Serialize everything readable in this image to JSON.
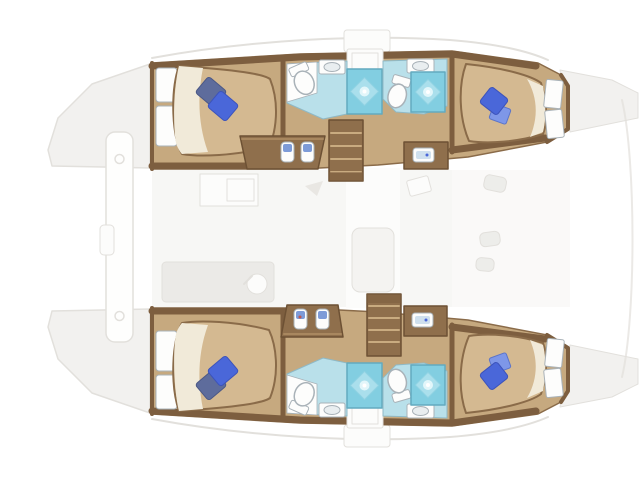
{
  "meta": {
    "description": "Top-down floor plan of a 4-cabin catamaran, bow to the left: two hulls each with a forward double berth cabin, twin bathroom units with toilet, sink and glowing shower pan, an aft double berth cabin, companionway stairs and vanity cabinets; faded salon, cockpit, crossbeam and deck outline between the hulls.",
    "text_on_image": ""
  },
  "palette": {
    "hull_wall": "#7d5e3f",
    "wood": "#8f6f4c",
    "wood_dark": "#6d5134",
    "wood_light": "#a8875f",
    "tread": "#c9ab80",
    "floor": "#c6a97f",
    "bed_top": "#d4b991",
    "bed_sheet": "#f1ead9",
    "bed_outline": "#8a6b49",
    "pillow_dark": "#5e6c9c",
    "pillow_dark_edge": "#4b5886",
    "pillow_blue": "#4a67d9",
    "pillow_blue_edge": "#3c53bb",
    "pillow_light": "#7e97e8",
    "pillow_light_edge": "#5b74c9",
    "bath_floor": "#b9e0ea",
    "bath_edge": "#8fb9c6",
    "shower": "#82cee1",
    "shower_edge": "#62aabf",
    "shower_tile": "#aadfec",
    "shower_tile_edge": "#8ed2e3",
    "shower_glow": "#e2f6fa",
    "fixture_white": "#fdfdfc",
    "fixture_stroke": "#a9b2b8",
    "sink_bowl": "#e9eef0",
    "sink_blue": "#cfe0ee",
    "seat_blue": "#7d9bd8",
    "accent_red": "#c2564f",
    "faded_fill": "#f2f1ef",
    "faded_stroke": "#e2e0dc",
    "salon_panel": "#f3f2f0",
    "walkway": "#fcfcfb"
  },
  "vessel": {
    "type": "catamaran",
    "orientation": "bow-left",
    "hulls": [
      {
        "id": "port-hull",
        "position": "top",
        "rooms": [
          {
            "name": "forward-cabin",
            "berth": "double",
            "pillows": 2,
            "steps": 2
          },
          {
            "name": "bathroom-forward",
            "toilet": 1,
            "sink": 1,
            "shower": 1
          },
          {
            "name": "bathroom-aft",
            "toilet": 1,
            "sink": 1,
            "shower": 1
          },
          {
            "name": "aft-cabin",
            "berth": "double",
            "pillows": 1,
            "windows": 2
          }
        ],
        "companionway": {
          "stairs_treads": 5,
          "desk_seats": 2,
          "vanity_sink": 1
        }
      },
      {
        "id": "starboard-hull",
        "position": "bottom",
        "rooms": [
          {
            "name": "forward-cabin",
            "berth": "double",
            "pillows": 2,
            "steps": 2
          },
          {
            "name": "bathroom-forward",
            "toilet": 1,
            "sink": 1,
            "shower": 1
          },
          {
            "name": "bathroom-aft",
            "toilet": 1,
            "sink": 1,
            "shower": 1
          },
          {
            "name": "aft-cabin",
            "berth": "double",
            "pillows": 1,
            "windows": 2
          }
        ],
        "companionway": {
          "stairs_treads": 5,
          "desk_seats": 2,
          "vanity_sink": 1
        }
      }
    ],
    "deck_faded": {
      "bow_wedges": 2,
      "crossbeam": true,
      "crossbeam_fittings": 2,
      "roof_hatches": 2,
      "salon_galley": true,
      "salon_table": true,
      "cockpit_cushions": 3,
      "stern_wedges": 2
    }
  }
}
